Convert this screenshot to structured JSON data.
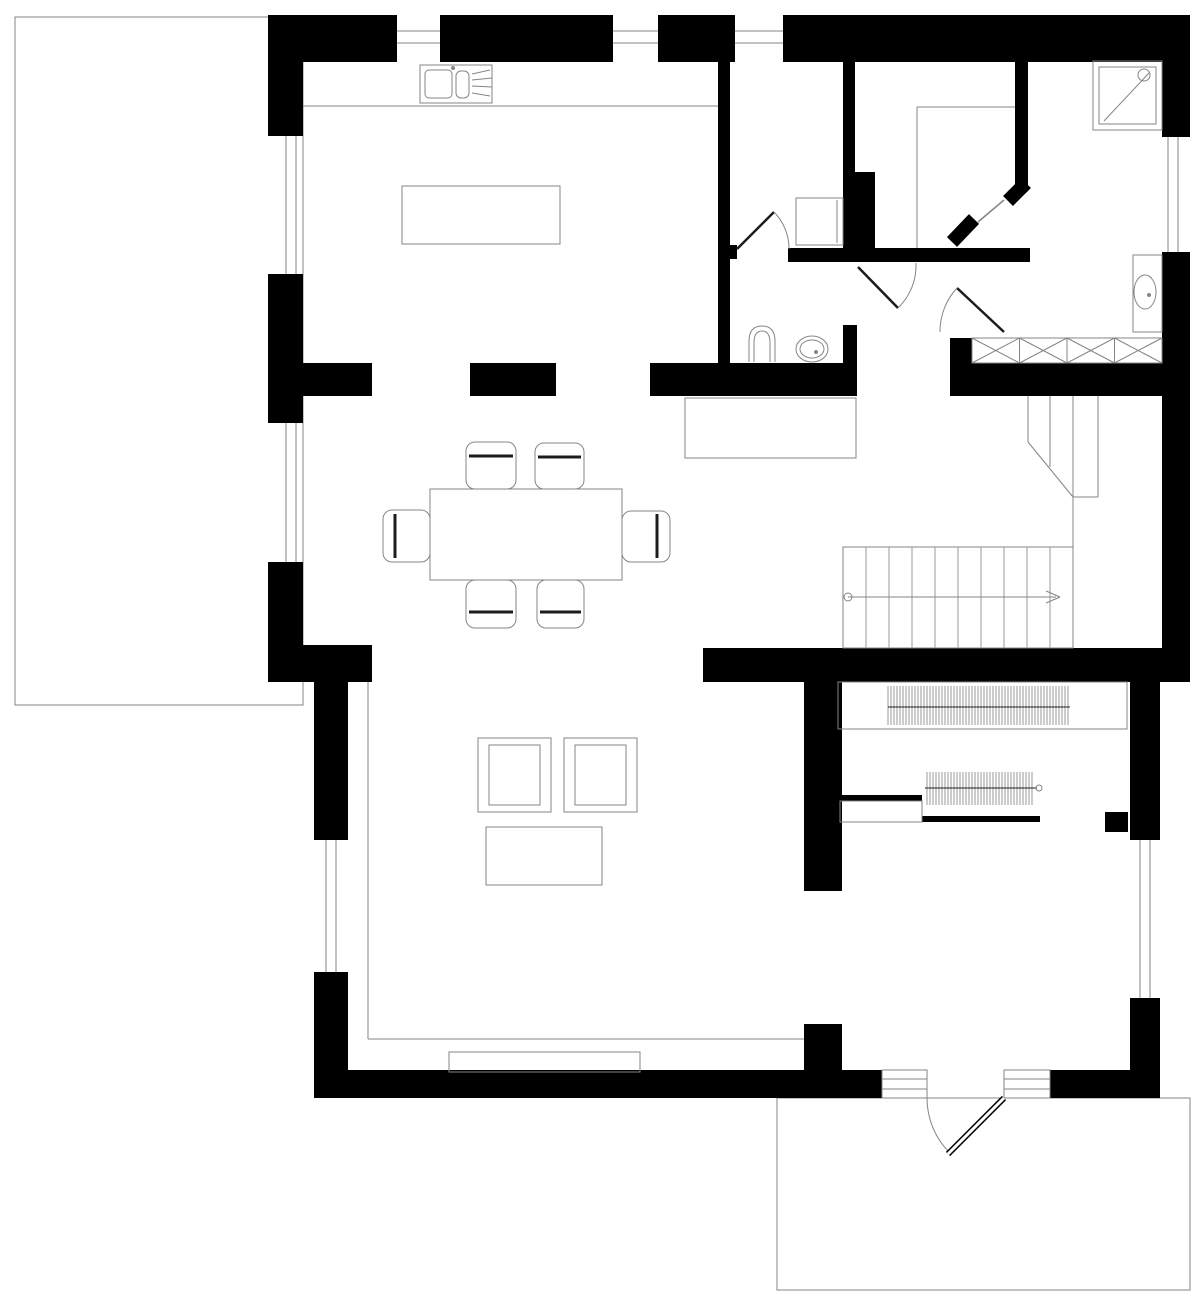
{
  "title": "house-ground-floor-plan",
  "canvas": {
    "width": 1200,
    "height": 1309,
    "colors": {
      "bg": "#ffffff",
      "wall": "#000000",
      "line": "#858585",
      "thin": "#9a9a9a",
      "hatch": "#9a9a9a",
      "band": "#1c1c1c",
      "white": "#ffffff"
    }
  },
  "shapes": [
    {
      "t": "box",
      "name": "terrace-left",
      "x": 15,
      "y": 17,
      "w": 288,
      "h": 688
    },
    {
      "t": "box",
      "name": "terrace-bottom-right",
      "x": 777,
      "y": 1098,
      "w": 413,
      "h": 192
    },
    {
      "t": "rect",
      "name": "wall-top-a",
      "x": 268,
      "y": 15,
      "w": 129,
      "h": 47
    },
    {
      "t": "rect",
      "name": "wall-top-b",
      "x": 440,
      "y": 15,
      "w": 173,
      "h": 47
    },
    {
      "t": "rect",
      "name": "wall-top-c",
      "x": 658,
      "y": 15,
      "w": 77,
      "h": 47
    },
    {
      "t": "rect",
      "name": "wall-top-d",
      "x": 783,
      "y": 15,
      "w": 379,
      "h": 47
    },
    {
      "t": "rect",
      "name": "wall-top-right-corner",
      "x": 1162,
      "y": 15,
      "w": 28,
      "h": 122
    },
    {
      "t": "rect",
      "name": "wall-left-a",
      "x": 268,
      "y": 15,
      "w": 35,
      "h": 121
    },
    {
      "t": "rect",
      "name": "wall-left-b",
      "x": 268,
      "y": 274,
      "w": 35,
      "h": 149
    },
    {
      "t": "rect",
      "name": "wall-left-c",
      "x": 268,
      "y": 562,
      "w": 35,
      "h": 120
    },
    {
      "t": "rect",
      "name": "wall-left-jog",
      "x": 268,
      "y": 645,
      "w": 104,
      "h": 37
    },
    {
      "t": "rect",
      "name": "wall-lowerleft-a",
      "x": 314,
      "y": 682,
      "w": 34,
      "h": 158
    },
    {
      "t": "rect",
      "name": "wall-lowerleft-b",
      "x": 314,
      "y": 972,
      "w": 34,
      "h": 126
    },
    {
      "t": "rect",
      "name": "wall-bottom-a",
      "x": 314,
      "y": 1070,
      "w": 568,
      "h": 28
    },
    {
      "t": "rect",
      "name": "wall-bottom-b",
      "x": 1050,
      "y": 1070,
      "w": 110,
      "h": 28
    },
    {
      "t": "rect",
      "name": "wall-lowerright-a",
      "x": 1130,
      "y": 680,
      "w": 30,
      "h": 160
    },
    {
      "t": "rect",
      "name": "wall-lowerright-b",
      "x": 1130,
      "y": 998,
      "w": 30,
      "h": 100
    },
    {
      "t": "rect",
      "name": "wall-upperright",
      "x": 1162,
      "y": 252,
      "w": 28,
      "h": 408
    },
    {
      "t": "rect",
      "name": "wall-mid-stub-1",
      "x": 268,
      "y": 363,
      "w": 104,
      "h": 33
    },
    {
      "t": "rect",
      "name": "wall-mid-stub-2",
      "x": 470,
      "y": 363,
      "w": 86,
      "h": 33
    },
    {
      "t": "rect",
      "name": "wall-mid-main",
      "x": 650,
      "y": 363,
      "w": 207,
      "h": 33
    },
    {
      "t": "rect",
      "name": "wall-niche-stub",
      "x": 843,
      "y": 325,
      "w": 14,
      "h": 71
    },
    {
      "t": "rect",
      "name": "wall-niche-nub",
      "x": 950,
      "y": 338,
      "w": 22,
      "h": 58
    },
    {
      "t": "rect",
      "name": "wall-mid-right",
      "x": 972,
      "y": 363,
      "w": 218,
      "h": 33
    },
    {
      "t": "rect",
      "name": "wall-stair-band",
      "x": 703,
      "y": 648,
      "w": 487,
      "h": 34
    },
    {
      "t": "rect",
      "name": "wall-kitchen-divider",
      "x": 718,
      "y": 62,
      "w": 12,
      "h": 301
    },
    {
      "t": "rect",
      "name": "wall-kitchen-divider-nub",
      "x": 730,
      "y": 245,
      "w": 7,
      "h": 14
    },
    {
      "t": "rect",
      "name": "wall-wc-divider",
      "x": 843,
      "y": 62,
      "w": 12,
      "h": 110
    },
    {
      "t": "rect",
      "name": "wall-wc-pier",
      "x": 843,
      "y": 172,
      "w": 32,
      "h": 90
    },
    {
      "t": "rect",
      "name": "wall-bath-top",
      "x": 788,
      "y": 248,
      "w": 242,
      "h": 14
    },
    {
      "t": "rect",
      "name": "wall-diagonal-pier",
      "x": 1015,
      "y": 62,
      "w": 13,
      "h": 123
    },
    {
      "t": "rect",
      "name": "wall-hall-upper",
      "x": 804,
      "y": 682,
      "w": 38,
      "h": 209
    },
    {
      "t": "rect",
      "name": "wall-hall-lower",
      "x": 804,
      "y": 1024,
      "w": 38,
      "h": 46
    },
    {
      "t": "rect",
      "name": "wall-pocket",
      "x": 837,
      "y": 795,
      "w": 85,
      "h": 6
    },
    {
      "t": "rect",
      "name": "wall-vestibule",
      "x": 922,
      "y": 816,
      "w": 118,
      "h": 6
    },
    {
      "t": "rect",
      "name": "wall-vestibule-nub",
      "x": 1105,
      "y": 812,
      "w": 23,
      "h": 20
    },
    {
      "t": "ln",
      "name": "diag-door-jamb-1",
      "x1": 1026,
      "y1": 183,
      "x2": 1008,
      "y2": 201,
      "sw": 14,
      "col": "wall"
    },
    {
      "t": "ln",
      "name": "diag-door-jamb-2",
      "x1": 974,
      "y1": 219,
      "x2": 952,
      "y2": 242,
      "sw": 14,
      "col": "wall"
    },
    {
      "t": "ln",
      "name": "diag-door-leaf",
      "x1": 1004,
      "y1": 200,
      "x2": 978,
      "y2": 222,
      "sw": 1.5
    },
    {
      "t": "ln",
      "name": "window-top-1-line-a",
      "x1": 397,
      "y1": 31,
      "x2": 440,
      "y2": 31
    },
    {
      "t": "ln",
      "name": "window-top-1-line-b",
      "x1": 397,
      "y1": 43,
      "x2": 440,
      "y2": 43
    },
    {
      "t": "ln",
      "name": "window-top-2-line-a",
      "x1": 613,
      "y1": 31,
      "x2": 658,
      "y2": 31
    },
    {
      "t": "ln",
      "name": "window-top-2-line-b",
      "x1": 613,
      "y1": 43,
      "x2": 658,
      "y2": 43
    },
    {
      "t": "ln",
      "name": "window-top-3-line-a",
      "x1": 735,
      "y1": 31,
      "x2": 783,
      "y2": 31
    },
    {
      "t": "ln",
      "name": "window-top-3-line-b",
      "x1": 735,
      "y1": 43,
      "x2": 783,
      "y2": 43
    },
    {
      "t": "ln",
      "name": "window-left-1-line-a",
      "x1": 286,
      "y1": 136,
      "x2": 286,
      "y2": 274
    },
    {
      "t": "ln",
      "name": "window-left-1-line-b",
      "x1": 296,
      "y1": 136,
      "x2": 296,
      "y2": 274
    },
    {
      "t": "ln",
      "name": "window-left-2-line-a",
      "x1": 286,
      "y1": 423,
      "x2": 286,
      "y2": 562
    },
    {
      "t": "ln",
      "name": "window-left-2-line-b",
      "x1": 296,
      "y1": 423,
      "x2": 296,
      "y2": 562
    },
    {
      "t": "ln",
      "name": "window-left-3-line-a",
      "x1": 326,
      "y1": 840,
      "x2": 326,
      "y2": 972
    },
    {
      "t": "ln",
      "name": "window-left-3-line-b",
      "x1": 336,
      "y1": 840,
      "x2": 336,
      "y2": 972
    },
    {
      "t": "ln",
      "name": "window-right-1-line-a",
      "x1": 1168,
      "y1": 137,
      "x2": 1168,
      "y2": 252
    },
    {
      "t": "ln",
      "name": "window-right-1-line-b",
      "x1": 1178,
      "y1": 137,
      "x2": 1178,
      "y2": 252
    },
    {
      "t": "ln",
      "name": "window-right-2-line-a",
      "x1": 1140,
      "y1": 840,
      "x2": 1140,
      "y2": 998
    },
    {
      "t": "ln",
      "name": "window-right-2-line-b",
      "x1": 1150,
      "y1": 840,
      "x2": 1150,
      "y2": 998
    },
    {
      "t": "ln",
      "name": "kitchen-counter-edge",
      "x1": 303,
      "y1": 106,
      "x2": 718,
      "y2": 106
    },
    {
      "t": "box",
      "name": "kitchen-sink-unit",
      "x": 420,
      "y": 65,
      "w": 72,
      "h": 38
    },
    {
      "t": "box",
      "name": "kitchen-sink-basin",
      "x": 425,
      "y": 70,
      "w": 27,
      "h": 28,
      "r": 4
    },
    {
      "t": "box",
      "name": "kitchen-sink-half-basin",
      "x": 456,
      "y": 71,
      "w": 13,
      "h": 27,
      "r": 5
    },
    {
      "t": "c",
      "name": "kitchen-sink-tap",
      "cx": 453,
      "cy": 68,
      "r": 1.5
    },
    {
      "t": "ln",
      "name": "kitchen-drainer-line-1",
      "x1": 472,
      "y1": 74,
      "x2": 490,
      "y2": 70
    },
    {
      "t": "ln",
      "name": "kitchen-drainer-line-2",
      "x1": 472,
      "y1": 80,
      "x2": 492,
      "y2": 78
    },
    {
      "t": "ln",
      "name": "kitchen-drainer-line-3",
      "x1": 472,
      "y1": 86,
      "x2": 492,
      "y2": 87
    },
    {
      "t": "ln",
      "name": "kitchen-drainer-line-4",
      "x1": 472,
      "y1": 93,
      "x2": 490,
      "y2": 96
    },
    {
      "t": "box",
      "name": "kitchen-island",
      "x": 402,
      "y": 186,
      "w": 158,
      "h": 58
    },
    {
      "t": "box",
      "name": "dining-table",
      "x": 430,
      "y": 489,
      "w": 192,
      "h": 91
    },
    {
      "t": "box",
      "name": "dining-chair-top-1",
      "x": 466,
      "y": 442,
      "w": 50,
      "h": 47,
      "r": 9
    },
    {
      "t": "ln",
      "name": "dining-chair-top-1-back",
      "x1": 469,
      "y1": 456,
      "x2": 513,
      "y2": 456,
      "sw": 3,
      "col": "band"
    },
    {
      "t": "box",
      "name": "dining-chair-top-2",
      "x": 535,
      "y": 443,
      "w": 49,
      "h": 46,
      "r": 9
    },
    {
      "t": "ln",
      "name": "dining-chair-top-2-back",
      "x1": 538,
      "y1": 457,
      "x2": 581,
      "y2": 457,
      "sw": 3,
      "col": "band"
    },
    {
      "t": "box",
      "name": "dining-chair-bottom-1",
      "x": 466,
      "y": 580,
      "w": 50,
      "h": 48,
      "r": 9
    },
    {
      "t": "ln",
      "name": "dining-chair-bottom-1-back",
      "x1": 469,
      "y1": 612,
      "x2": 513,
      "y2": 612,
      "sw": 3,
      "col": "band"
    },
    {
      "t": "box",
      "name": "dining-chair-bottom-2",
      "x": 537,
      "y": 580,
      "w": 47,
      "h": 48,
      "r": 9
    },
    {
      "t": "ln",
      "name": "dining-chair-bottom-2-back",
      "x1": 540,
      "y1": 612,
      "x2": 581,
      "y2": 612,
      "sw": 3,
      "col": "band"
    },
    {
      "t": "box",
      "name": "dining-chair-left",
      "x": 383,
      "y": 510,
      "w": 47,
      "h": 52,
      "r": 9
    },
    {
      "t": "ln",
      "name": "dining-chair-left-back",
      "x1": 395,
      "y1": 514,
      "x2": 395,
      "y2": 558,
      "sw": 3,
      "col": "band"
    },
    {
      "t": "box",
      "name": "dining-chair-right",
      "x": 622,
      "y": 511,
      "w": 48,
      "h": 51,
      "r": 9
    },
    {
      "t": "ln",
      "name": "dining-chair-right-back",
      "x1": 657,
      "y1": 514,
      "x2": 657,
      "y2": 558,
      "sw": 3,
      "col": "band"
    },
    {
      "t": "box",
      "name": "armchair-1",
      "x": 478,
      "y": 738,
      "w": 73,
      "h": 74
    },
    {
      "t": "box",
      "name": "armchair-1-seat",
      "x": 489,
      "y": 745,
      "w": 51,
      "h": 60
    },
    {
      "t": "box",
      "name": "armchair-2",
      "x": 564,
      "y": 738,
      "w": 73,
      "h": 74
    },
    {
      "t": "box",
      "name": "armchair-2-seat",
      "x": 575,
      "y": 745,
      "w": 51,
      "h": 60
    },
    {
      "t": "box",
      "name": "coffee-table",
      "x": 486,
      "y": 827,
      "w": 116,
      "h": 58
    },
    {
      "t": "p",
      "name": "toilet-bowl",
      "d": "M 749,362 L 749,341 Q 749,326 762,326 Q 775,326 775,341 L 775,362"
    },
    {
      "t": "p",
      "name": "toilet-bowl-inner",
      "d": "M 754,362 L 754,343 Q 754,331 762,331 Q 770,331 770,343 L 770,362"
    },
    {
      "t": "e",
      "name": "bathroom-sink",
      "cx": 812,
      "cy": 349,
      "rx": 16,
      "ry": 13
    },
    {
      "t": "e",
      "name": "bathroom-sink-inner",
      "cx": 812,
      "cy": 349,
      "rx": 12,
      "ry": 9
    },
    {
      "t": "c",
      "name": "bathroom-sink-drain",
      "cx": 816,
      "cy": 352,
      "r": 1.5
    },
    {
      "t": "box",
      "name": "washing-machine",
      "x": 796,
      "y": 198,
      "w": 47,
      "h": 47
    },
    {
      "t": "ln",
      "name": "washing-machine-edge",
      "x1": 837,
      "y1": 200,
      "x2": 837,
      "y2": 243
    },
    {
      "t": "box",
      "name": "shower-tray",
      "x": 1093,
      "y": 61,
      "w": 69,
      "h": 69
    },
    {
      "t": "box",
      "name": "shower-tray-inner",
      "x": 1099,
      "y": 67,
      "w": 57,
      "h": 57
    },
    {
      "t": "ln",
      "name": "shower-drain-line",
      "x1": 1104,
      "y1": 121,
      "x2": 1149,
      "y2": 73
    },
    {
      "t": "c",
      "name": "shower-head",
      "cx": 1144,
      "cy": 75,
      "r": 6
    },
    {
      "t": "box",
      "name": "vanity-counter",
      "x": 1133,
      "y": 255,
      "w": 29,
      "h": 77
    },
    {
      "t": "e",
      "name": "vanity-sink",
      "cx": 1145,
      "cy": 292,
      "rx": 11,
      "ry": 17
    },
    {
      "t": "c",
      "name": "vanity-sink-drain",
      "cx": 1149,
      "cy": 295,
      "r": 1.5
    },
    {
      "t": "xrow",
      "name": "wardrobe-cabinet",
      "x": 972,
      "y": 338,
      "w": 190,
      "h": 25,
      "n": 4
    },
    {
      "t": "box",
      "name": "hall-sideboard",
      "x": 685,
      "y": 398,
      "w": 171,
      "h": 60
    },
    {
      "t": "box",
      "name": "closet-outline",
      "x": 838,
      "y": 682,
      "w": 289,
      "h": 47
    },
    {
      "t": "vlines",
      "name": "closet-hanger-hatch",
      "x": 888,
      "y": 686,
      "w": 182,
      "h": 39,
      "step": 3
    },
    {
      "t": "ln",
      "name": "closet-hanger-rail",
      "x1": 888,
      "y1": 707,
      "x2": 1070,
      "y2": 707,
      "col": "band"
    },
    {
      "t": "vlines",
      "name": "coat-rod-hatch",
      "x": 927,
      "y": 772,
      "w": 106,
      "h": 33,
      "step": 3
    },
    {
      "t": "ln",
      "name": "coat-rod-rail",
      "x1": 925,
      "y1": 788,
      "x2": 1037,
      "y2": 788,
      "col": "band"
    },
    {
      "t": "c",
      "name": "coat-rod-end",
      "cx": 1039,
      "cy": 788,
      "r": 3
    },
    {
      "t": "box",
      "name": "pocket-door-cassette",
      "x": 840,
      "y": 801,
      "w": 82,
      "h": 21
    },
    {
      "t": "box",
      "name": "stairs-outline",
      "x": 843,
      "y": 547,
      "w": 230,
      "h": 101
    },
    {
      "t": "vlines",
      "name": "stairs-treads",
      "x": 866,
      "y": 547,
      "w": 184,
      "h": 101,
      "step": 23
    },
    {
      "t": "ln",
      "name": "stairs-walkline",
      "x1": 848,
      "y1": 597,
      "x2": 1056,
      "y2": 597
    },
    {
      "t": "c",
      "name": "stairs-walkline-start",
      "cx": 848,
      "cy": 597,
      "r": 4
    },
    {
      "t": "ln",
      "name": "stairs-arrow-a",
      "x1": 1046,
      "y1": 591,
      "x2": 1060,
      "y2": 597
    },
    {
      "t": "ln",
      "name": "stairs-arrow-b",
      "x1": 1046,
      "y1": 603,
      "x2": 1060,
      "y2": 597
    },
    {
      "t": "ln",
      "name": "stairs-upper-line-1",
      "x1": 1028,
      "y1": 396,
      "x2": 1028,
      "y2": 442
    },
    {
      "t": "ln",
      "name": "stairs-upper-line-2",
      "x1": 1050,
      "y1": 396,
      "x2": 1050,
      "y2": 467
    },
    {
      "t": "ln",
      "name": "stairs-upper-line-3",
      "x1": 1073,
      "y1": 396,
      "x2": 1073,
      "y2": 547
    },
    {
      "t": "ln",
      "name": "stairs-upper-line-4",
      "x1": 1098,
      "y1": 396,
      "x2": 1098,
      "y2": 497
    },
    {
      "t": "ln",
      "name": "stairs-break-diagonal",
      "x1": 1028,
      "y1": 442,
      "x2": 1073,
      "y2": 497
    },
    {
      "t": "ln",
      "name": "stairs-upper-bottom",
      "x1": 1073,
      "y1": 497,
      "x2": 1098,
      "y2": 497
    },
    {
      "t": "ln",
      "name": "landing-line-h",
      "x1": 917,
      "y1": 107,
      "x2": 1015,
      "y2": 107
    },
    {
      "t": "ln",
      "name": "landing-line-v",
      "x1": 917,
      "y1": 107,
      "x2": 917,
      "y2": 248
    },
    {
      "t": "ln",
      "name": "living-floor-line-v",
      "x1": 368,
      "y1": 682,
      "x2": 368,
      "y2": 1039
    },
    {
      "t": "ln",
      "name": "living-floor-line-h",
      "x1": 368,
      "y1": 1039,
      "x2": 804,
      "y2": 1039
    },
    {
      "t": "box",
      "name": "terrace-door-sill",
      "x": 449,
      "y": 1052,
      "w": 191,
      "h": 20
    },
    {
      "t": "ln",
      "name": "bath-door-leaf",
      "x1": 737,
      "y1": 249,
      "x2": 774,
      "y2": 212,
      "sw": 2.5,
      "col": "band"
    },
    {
      "t": "p",
      "name": "bath-door-swing",
      "d": "M 774,212 A 52,52 0 0 1 789,249"
    },
    {
      "t": "ln",
      "name": "niche-door-a-leaf",
      "x1": 858,
      "y1": 267,
      "x2": 898,
      "y2": 308,
      "sw": 2.5,
      "col": "band"
    },
    {
      "t": "p",
      "name": "niche-door-a-swing",
      "d": "M 898,308 A 59,59 0 0 0 916,263"
    },
    {
      "t": "ln",
      "name": "niche-door-b-leaf",
      "x1": 957,
      "y1": 288,
      "x2": 1004,
      "y2": 332,
      "sw": 2.5,
      "col": "band"
    },
    {
      "t": "p",
      "name": "niche-door-b-swing",
      "d": "M 957,288 A 64,64 0 0 0 940,332"
    },
    {
      "t": "box",
      "name": "entry-sill-left",
      "x": 882,
      "y": 1070,
      "w": 45,
      "h": 28,
      "f": "#ffffff"
    },
    {
      "t": "ln",
      "name": "entry-sill-left-line-a",
      "x1": 882,
      "y1": 1079,
      "x2": 927,
      "y2": 1079
    },
    {
      "t": "ln",
      "name": "entry-sill-left-line-b",
      "x1": 882,
      "y1": 1089,
      "x2": 927,
      "y2": 1089
    },
    {
      "t": "box",
      "name": "entry-sill-right",
      "x": 1004,
      "y": 1070,
      "w": 46,
      "h": 28,
      "f": "#ffffff"
    },
    {
      "t": "ln",
      "name": "entry-sill-right-line-a",
      "x1": 1004,
      "y1": 1079,
      "x2": 1050,
      "y2": 1079
    },
    {
      "t": "ln",
      "name": "entry-sill-right-line-b",
      "x1": 1004,
      "y1": 1089,
      "x2": 1050,
      "y2": 1089
    },
    {
      "t": "p",
      "name": "entry-door-swing",
      "d": "M 927,1098 A 77,77 0 0 0 949,1152"
    },
    {
      "t": "ln",
      "name": "entry-door-leaf-outer",
      "x1": 1004,
      "y1": 1098,
      "x2": 948,
      "y2": 1154,
      "sw": 6,
      "col": "wall"
    },
    {
      "t": "ln",
      "name": "entry-door-leaf-core",
      "x1": 1004,
      "y1": 1098,
      "x2": 948,
      "y2": 1154,
      "sw": 3,
      "col": "white"
    }
  ]
}
